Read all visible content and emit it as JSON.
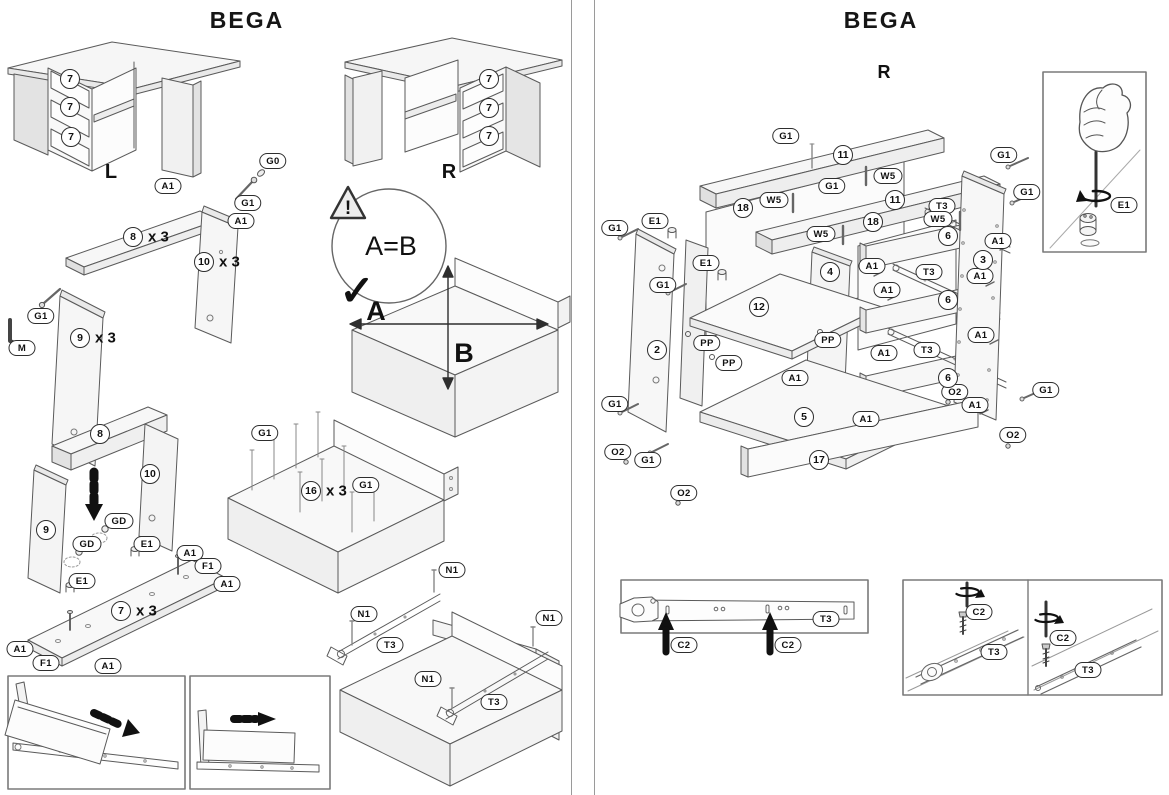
{
  "document_type": "furniture-assembly-instructions",
  "product": "BEGA",
  "left_page": {
    "title": "BEGA",
    "desk_left_variant": "L",
    "desk_right_variant": "R",
    "check_figure": {
      "warning_mark": "!",
      "equation": "A=B",
      "checkmark": "✓",
      "dim_horizontal": "A",
      "dim_vertical": "B"
    },
    "labels": [
      {
        "kind": "oval",
        "text": "A1",
        "x": 168,
        "y": 186
      },
      {
        "kind": "oval",
        "text": "G0",
        "x": 273,
        "y": 161
      },
      {
        "kind": "oval",
        "text": "G1",
        "x": 248,
        "y": 203
      },
      {
        "kind": "oval",
        "text": "A1",
        "x": 241,
        "y": 221
      },
      {
        "kind": "oval",
        "text": "G1",
        "x": 41,
        "y": 316
      },
      {
        "kind": "oval",
        "text": "M",
        "x": 22,
        "y": 348
      },
      {
        "kind": "oval",
        "text": "GD",
        "x": 119,
        "y": 521
      },
      {
        "kind": "oval",
        "text": "GD",
        "x": 87,
        "y": 544
      },
      {
        "kind": "oval",
        "text": "E1",
        "x": 147,
        "y": 544
      },
      {
        "kind": "oval",
        "text": "E1",
        "x": 82,
        "y": 581
      },
      {
        "kind": "oval",
        "text": "A1",
        "x": 190,
        "y": 553
      },
      {
        "kind": "oval",
        "text": "F1",
        "x": 208,
        "y": 566
      },
      {
        "kind": "oval",
        "text": "A1",
        "x": 227,
        "y": 584
      },
      {
        "kind": "oval",
        "text": "A1",
        "x": 20,
        "y": 649
      },
      {
        "kind": "oval",
        "text": "F1",
        "x": 46,
        "y": 663
      },
      {
        "kind": "oval",
        "text": "A1",
        "x": 108,
        "y": 666
      },
      {
        "kind": "oval",
        "text": "G1",
        "x": 265,
        "y": 433
      },
      {
        "kind": "oval",
        "text": "G1",
        "x": 366,
        "y": 485
      },
      {
        "kind": "oval",
        "text": "N1",
        "x": 452,
        "y": 570
      },
      {
        "kind": "oval",
        "text": "N1",
        "x": 364,
        "y": 614
      },
      {
        "kind": "oval",
        "text": "T3",
        "x": 390,
        "y": 645
      },
      {
        "kind": "oval",
        "text": "N1",
        "x": 549,
        "y": 618
      },
      {
        "kind": "oval",
        "text": "N1",
        "x": 428,
        "y": 679
      },
      {
        "kind": "oval",
        "text": "T3",
        "x": 494,
        "y": 702
      },
      {
        "kind": "circle",
        "text": "7",
        "x": 70,
        "y": 79
      },
      {
        "kind": "circle",
        "text": "7",
        "x": 70,
        "y": 107
      },
      {
        "kind": "circle",
        "text": "7",
        "x": 71,
        "y": 137
      },
      {
        "kind": "circle",
        "text": "7",
        "x": 489,
        "y": 79
      },
      {
        "kind": "circle",
        "text": "7",
        "x": 489,
        "y": 108
      },
      {
        "kind": "circle",
        "text": "7",
        "x": 489,
        "y": 136
      },
      {
        "kind": "circle",
        "text": "8",
        "x": 133,
        "y": 237,
        "mult": "x 3"
      },
      {
        "kind": "circle",
        "text": "10",
        "x": 204,
        "y": 262,
        "mult": "x 3"
      },
      {
        "kind": "circle",
        "text": "9",
        "x": 80,
        "y": 338,
        "mult": "x 3"
      },
      {
        "kind": "circle",
        "text": "8",
        "x": 100,
        "y": 434
      },
      {
        "kind": "circle",
        "text": "10",
        "x": 150,
        "y": 474
      },
      {
        "kind": "circle",
        "text": "9",
        "x": 46,
        "y": 530
      },
      {
        "kind": "circle",
        "text": "7",
        "x": 121,
        "y": 611,
        "mult": "x 3"
      },
      {
        "kind": "circle",
        "text": "16",
        "x": 311,
        "y": 491,
        "mult": "x 3"
      }
    ]
  },
  "right_page": {
    "title": "BEGA",
    "variant": "R",
    "labels": [
      {
        "kind": "oval",
        "text": "G1",
        "x": 786,
        "y": 136
      },
      {
        "kind": "oval",
        "text": "G1",
        "x": 1004,
        "y": 155
      },
      {
        "kind": "oval",
        "text": "W5",
        "x": 888,
        "y": 176
      },
      {
        "kind": "oval",
        "text": "G1",
        "x": 832,
        "y": 186
      },
      {
        "kind": "oval",
        "text": "W5",
        "x": 774,
        "y": 200
      },
      {
        "kind": "oval",
        "text": "T3",
        "x": 942,
        "y": 206
      },
      {
        "kind": "oval",
        "text": "W5",
        "x": 938,
        "y": 219
      },
      {
        "kind": "oval",
        "text": "G1",
        "x": 1027,
        "y": 192
      },
      {
        "kind": "oval",
        "text": "E1",
        "x": 655,
        "y": 221
      },
      {
        "kind": "oval",
        "text": "G1",
        "x": 615,
        "y": 228
      },
      {
        "kind": "oval",
        "text": "W5",
        "x": 821,
        "y": 234
      },
      {
        "kind": "oval",
        "text": "A1",
        "x": 998,
        "y": 241
      },
      {
        "kind": "oval",
        "text": "E1",
        "x": 706,
        "y": 263
      },
      {
        "kind": "oval",
        "text": "A1",
        "x": 872,
        "y": 266
      },
      {
        "kind": "oval",
        "text": "T3",
        "x": 929,
        "y": 272
      },
      {
        "kind": "oval",
        "text": "A1",
        "x": 980,
        "y": 276
      },
      {
        "kind": "oval",
        "text": "G1",
        "x": 663,
        "y": 285
      },
      {
        "kind": "oval",
        "text": "A1",
        "x": 887,
        "y": 290
      },
      {
        "kind": "oval",
        "text": "A1",
        "x": 981,
        "y": 335
      },
      {
        "kind": "oval",
        "text": "PP",
        "x": 707,
        "y": 343
      },
      {
        "kind": "oval",
        "text": "PP",
        "x": 828,
        "y": 340
      },
      {
        "kind": "oval",
        "text": "A1",
        "x": 884,
        "y": 353
      },
      {
        "kind": "oval",
        "text": "T3",
        "x": 927,
        "y": 350
      },
      {
        "kind": "oval",
        "text": "PP",
        "x": 729,
        "y": 363
      },
      {
        "kind": "oval",
        "text": "A1",
        "x": 795,
        "y": 378
      },
      {
        "kind": "oval",
        "text": "O2",
        "x": 955,
        "y": 392
      },
      {
        "kind": "oval",
        "text": "G1",
        "x": 615,
        "y": 404
      },
      {
        "kind": "oval",
        "text": "A1",
        "x": 975,
        "y": 405
      },
      {
        "kind": "oval",
        "text": "G1",
        "x": 1046,
        "y": 390
      },
      {
        "kind": "oval",
        "text": "A1",
        "x": 866,
        "y": 419
      },
      {
        "kind": "oval",
        "text": "O2",
        "x": 1013,
        "y": 435
      },
      {
        "kind": "oval",
        "text": "O2",
        "x": 618,
        "y": 452
      },
      {
        "kind": "oval",
        "text": "G1",
        "x": 648,
        "y": 460
      },
      {
        "kind": "oval",
        "text": "O2",
        "x": 684,
        "y": 493
      },
      {
        "kind": "oval",
        "text": "E1",
        "x": 1124,
        "y": 205
      },
      {
        "kind": "oval",
        "text": "T3",
        "x": 826,
        "y": 619
      },
      {
        "kind": "oval",
        "text": "C2",
        "x": 684,
        "y": 645
      },
      {
        "kind": "oval",
        "text": "C2",
        "x": 788,
        "y": 645
      },
      {
        "kind": "oval",
        "text": "C2",
        "x": 979,
        "y": 612
      },
      {
        "kind": "oval",
        "text": "T3",
        "x": 994,
        "y": 652
      },
      {
        "kind": "oval",
        "text": "C2",
        "x": 1063,
        "y": 638
      },
      {
        "kind": "oval",
        "text": "T3",
        "x": 1088,
        "y": 670
      },
      {
        "kind": "circle",
        "text": "11",
        "x": 843,
        "y": 155
      },
      {
        "kind": "circle",
        "text": "11",
        "x": 895,
        "y": 200
      },
      {
        "kind": "circle",
        "text": "18",
        "x": 743,
        "y": 208
      },
      {
        "kind": "circle",
        "text": "18",
        "x": 873,
        "y": 222
      },
      {
        "kind": "circle",
        "text": "6",
        "x": 948,
        "y": 236
      },
      {
        "kind": "circle",
        "text": "4",
        "x": 830,
        "y": 272
      },
      {
        "kind": "circle",
        "text": "3",
        "x": 983,
        "y": 260
      },
      {
        "kind": "circle",
        "text": "6",
        "x": 948,
        "y": 300
      },
      {
        "kind": "circle",
        "text": "12",
        "x": 759,
        "y": 307
      },
      {
        "kind": "circle",
        "text": "2",
        "x": 657,
        "y": 350
      },
      {
        "kind": "circle",
        "text": "6",
        "x": 948,
        "y": 378
      },
      {
        "kind": "circle",
        "text": "5",
        "x": 804,
        "y": 417
      },
      {
        "kind": "circle",
        "text": "17",
        "x": 819,
        "y": 460
      }
    ]
  }
}
